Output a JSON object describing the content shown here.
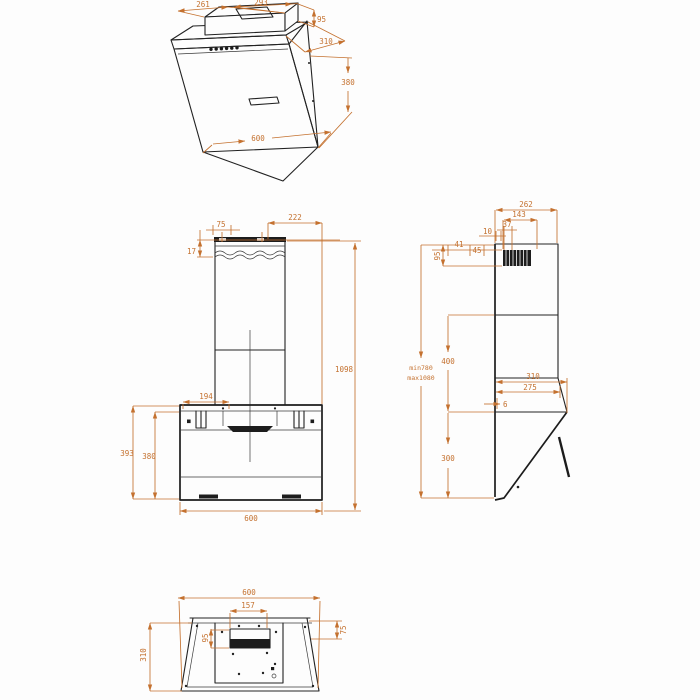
{
  "drawing": {
    "type": "technical-dimension-drawing",
    "product": "wall-mounted angled cooker hood",
    "colors": {
      "dimension": "#c4712f",
      "line": "#222222",
      "background": "#ffffff"
    },
    "views": {
      "perspective": {
        "label": "perspective view",
        "dims": {
          "top_duct_width": "261",
          "top_duct_depth": "293",
          "duct_height": "95",
          "top_depth": "310",
          "front_height": "380",
          "width": "600"
        }
      },
      "front": {
        "label": "front view",
        "dims": {
          "slot_offset": "75",
          "wall_clearance": "17",
          "right_offset": "222",
          "total_height": "1098",
          "bracket_span": "194",
          "outer_height": "393",
          "body_height": "380",
          "width": "600"
        }
      },
      "side": {
        "label": "side view",
        "dims": {
          "depth_total": "262",
          "outlet_offset": "143",
          "outlet_size": "37",
          "wall_gap": "10",
          "offset_a": "41",
          "offset_b": "45",
          "collar_height": "95",
          "height_min": "min780",
          "height_max": "max1080",
          "chimney_section": "400",
          "body_depth": "310",
          "body_depth_inner": "275",
          "back_gap": "6",
          "body_height": "300"
        }
      },
      "bottom": {
        "label": "bottom view",
        "dims": {
          "width": "600",
          "filter_cutout_width": "157",
          "filter_cutout_depth": "95",
          "edge_inset": "75",
          "depth": "310"
        }
      }
    }
  }
}
